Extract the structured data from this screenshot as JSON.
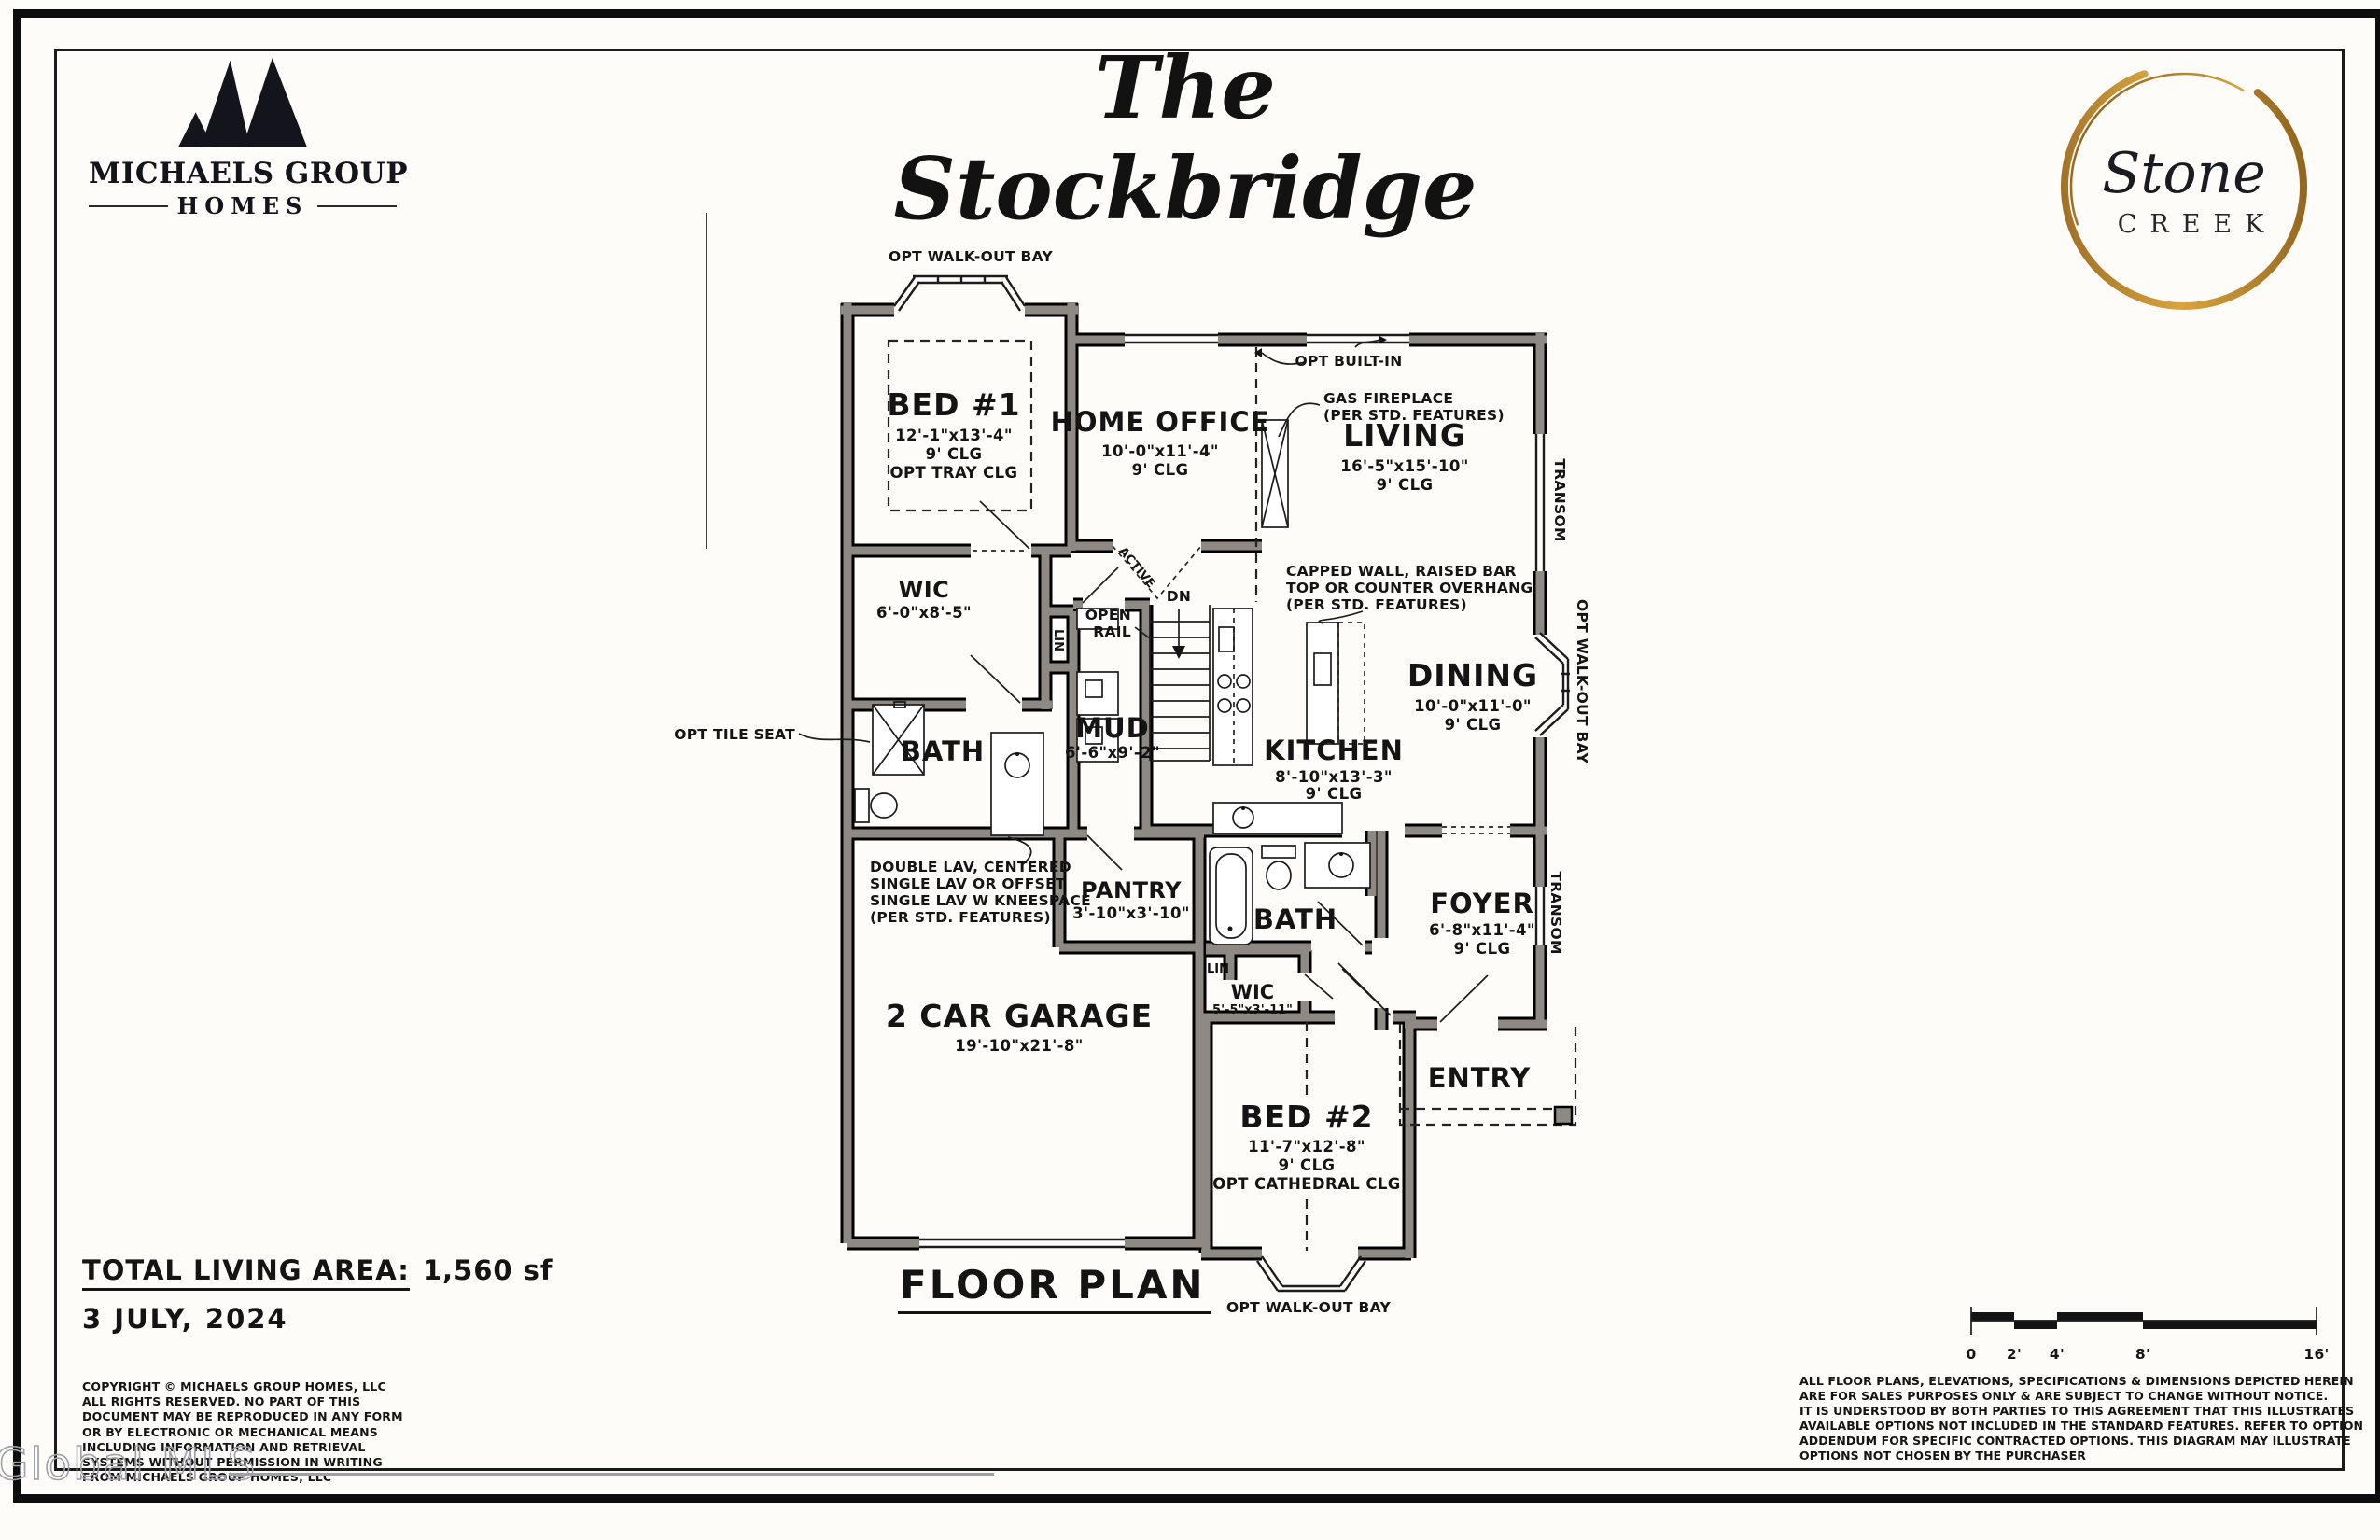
{
  "branding": {
    "builder": {
      "name_line": "MICHAELS GROUP",
      "sub_line": "HOMES"
    },
    "community": {
      "script": "Stone",
      "sub": "CREEK"
    }
  },
  "header": {
    "plan_title": "The Stockbridge"
  },
  "floor_plan": {
    "sheet_label": "FLOOR PLAN",
    "rooms": {
      "bed1": {
        "name": "BED #1",
        "dim": "12'-1\"x13'-4\"",
        "clg": "9' CLG",
        "opt": "OPT TRAY CLG"
      },
      "home_office": {
        "name": "HOME OFFICE",
        "dim": "10'-0\"x11'-4\"",
        "clg": "9' CLG"
      },
      "living": {
        "name": "LIVING",
        "dim": "16'-5\"x15'-10\"",
        "clg": "9' CLG"
      },
      "dining": {
        "name": "DINING",
        "dim": "10'-0\"x11'-0\"",
        "clg": "9' CLG"
      },
      "kitchen": {
        "name": "KITCHEN",
        "dim": "8'-10\"x13'-3\"",
        "clg": "9' CLG"
      },
      "mud": {
        "name": "MUD",
        "dim": "6'-6\"x9'-2\""
      },
      "wic1": {
        "name": "WIC",
        "dim": "6'-0\"x8'-5\""
      },
      "bath1": {
        "name": "BATH"
      },
      "lin1": {
        "name": "LIN"
      },
      "pantry": {
        "name": "PANTRY",
        "dim": "3'-10\"x3'-10\""
      },
      "bath2": {
        "name": "BATH"
      },
      "lin2": {
        "name": "LIN"
      },
      "wic2": {
        "name": "WIC",
        "dim": "5'-5\"x3'-11\""
      },
      "foyer": {
        "name": "FOYER",
        "dim": "6'-8\"x11'-4\"",
        "clg": "9' CLG"
      },
      "entry": {
        "name": "ENTRY"
      },
      "bed2": {
        "name": "BED #2",
        "dim": "11'-7\"x12'-8\"",
        "clg": "9' CLG",
        "opt": "OPT CATHEDRAL CLG"
      },
      "garage": {
        "name": "2 CAR GARAGE",
        "dim": "19'-10\"x21'-8\""
      }
    },
    "annotations": {
      "walk_out_bay": "OPT WALK-OUT BAY",
      "transom": "TRANSOM",
      "opt_built_in": "OPT BUILT-IN",
      "gas_fireplace": [
        "GAS FIREPLACE",
        "(PER STD. FEATURES)"
      ],
      "capped_wall": [
        "CAPPED WALL, RAISED BAR",
        "TOP OR COUNTER OVERHANG",
        "(PER STD. FEATURES)"
      ],
      "opt_tile_seat": "OPT TILE SEAT",
      "double_lav": [
        "DOUBLE LAV, CENTERED",
        "SINGLE LAV OR OFFSET",
        "SINGLE LAV W KNEESPACE",
        "(PER STD. FEATURES)"
      ],
      "open_rail": [
        "OPEN",
        "RAIL"
      ],
      "down": "DN",
      "active": "ACTIVE"
    }
  },
  "footer": {
    "area_label": "TOTAL LIVING AREA:",
    "area_value": "1,560 sf",
    "date": "3 JULY, 2024",
    "copyright_lines": [
      "COPYRIGHT © MICHAELS GROUP HOMES, LLC",
      "ALL RIGHTS RESERVED.  NO PART OF THIS",
      "DOCUMENT MAY BE REPRODUCED IN ANY FORM",
      "OR BY ELECTRONIC OR MECHANICAL MEANS",
      "INCLUDING INFORMATION AND RETRIEVAL",
      "SYSTEMS WITHOUT PERMISSION IN WRITING",
      "FROM MICHAELS GROUP HOMES, LLC"
    ],
    "disclaimer_lines": [
      "ALL FLOOR PLANS, ELEVATIONS, SPECIFICATIONS & DIMENSIONS DEPICTED HEREIN",
      "ARE FOR SALES PURPOSES ONLY & ARE SUBJECT TO CHANGE WITHOUT NOTICE.",
      "IT IS UNDERSTOOD BY BOTH PARTIES TO THIS AGREEMENT THAT THIS ILLUSTRATES",
      "AVAILABLE OPTIONS NOT INCLUDED IN THE STANDARD FEATURES.  REFER TO OPTION",
      "ADDENDUM FOR SPECIFIC CONTRACTED OPTIONS.  THIS DIAGRAM MAY ILLUSTRATE",
      "OPTIONS NOT CHOSEN BY THE PURCHASER"
    ],
    "scale_ticks": [
      "0",
      "2'",
      "4'",
      "8'",
      "16'"
    ]
  },
  "watermark": "Global MLS"
}
